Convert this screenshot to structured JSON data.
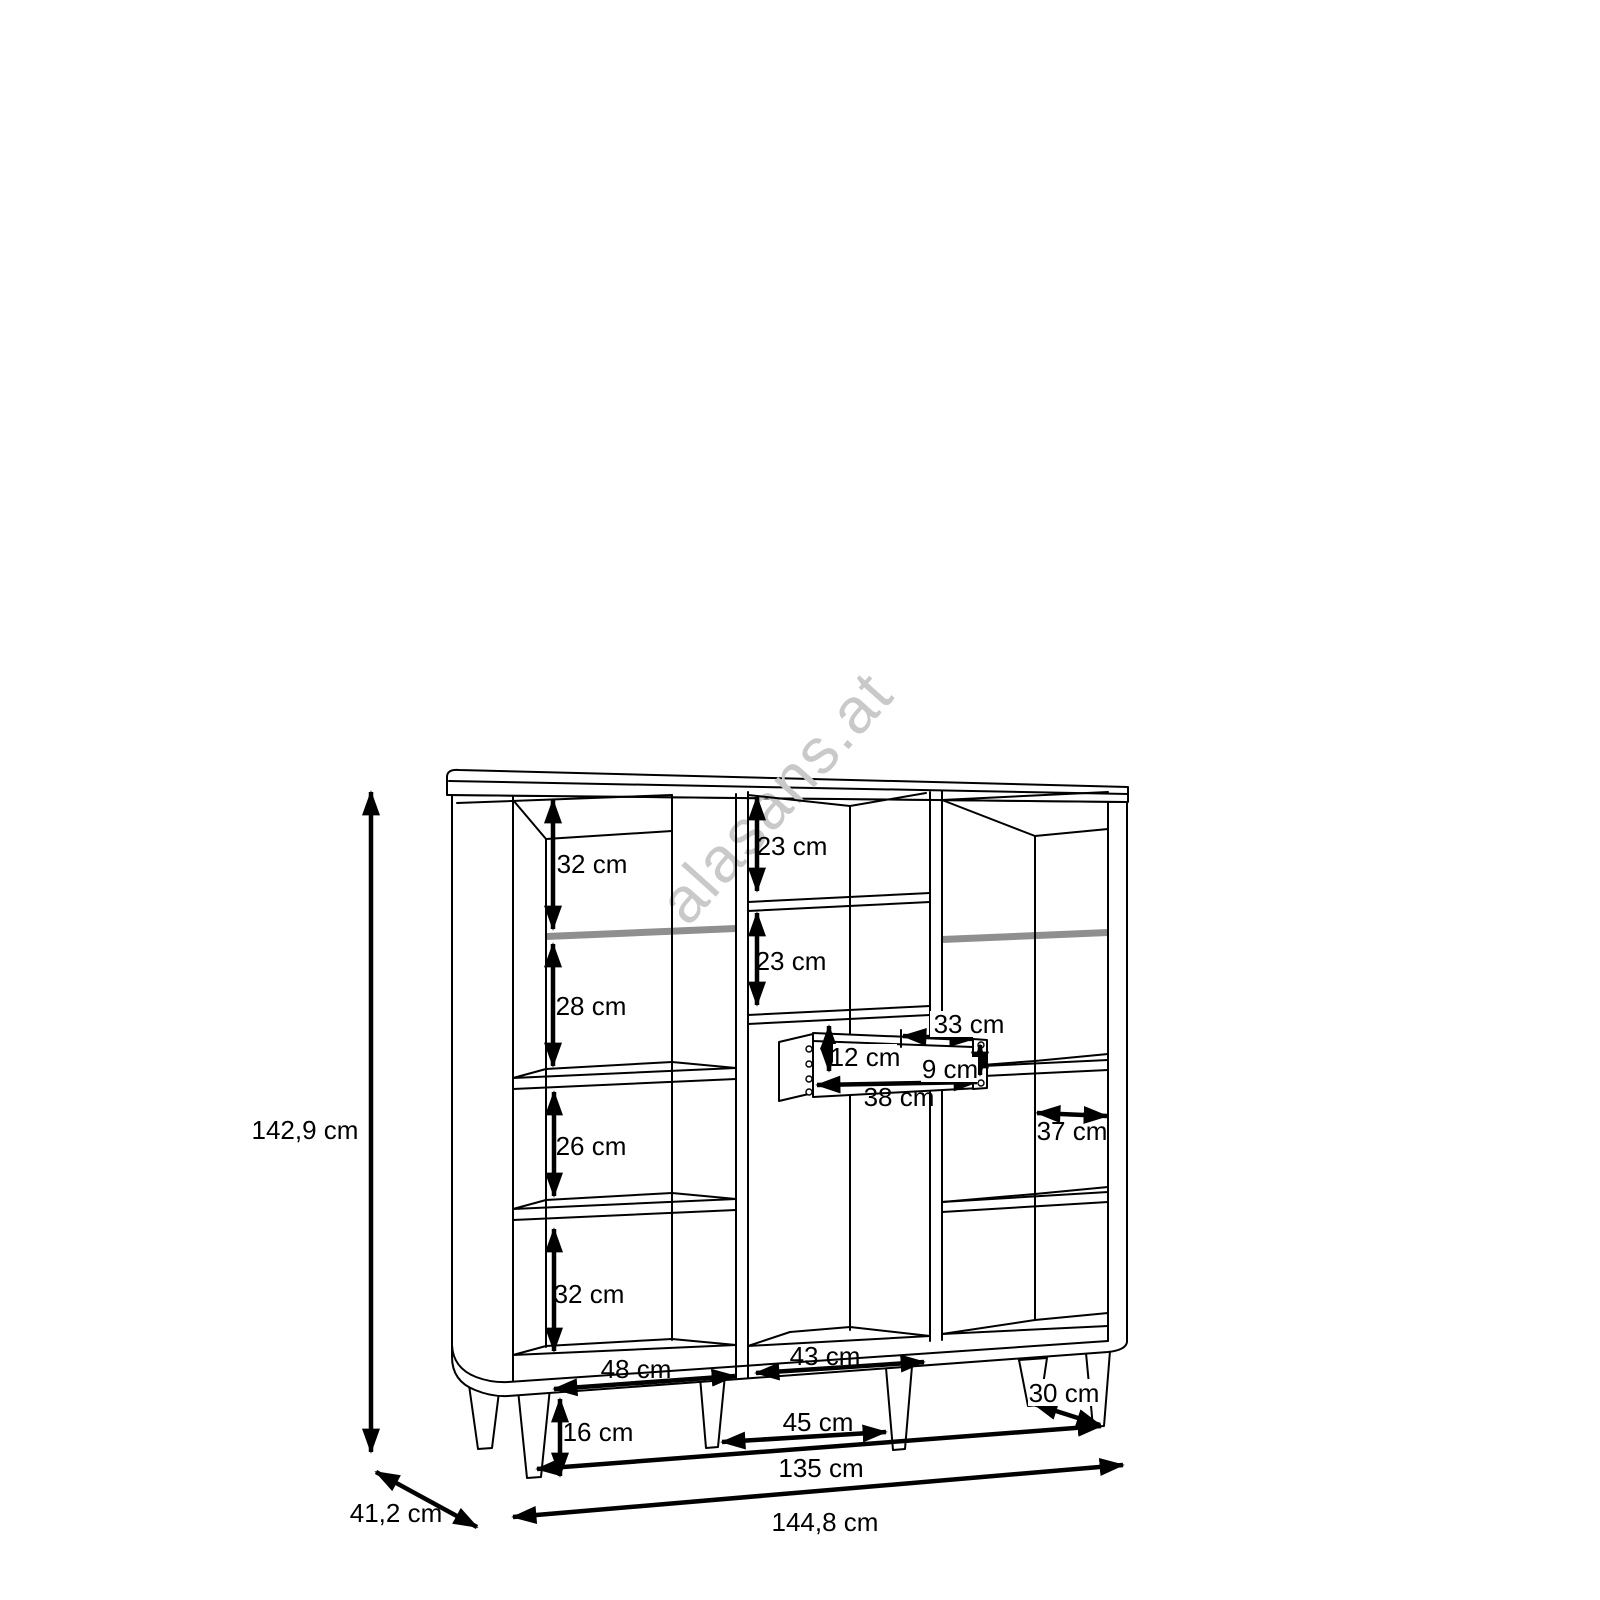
{
  "watermark": {
    "text": "alasans.at"
  },
  "diagram": {
    "kind": "cabinet-dimension-drawing",
    "unit": "cm",
    "labels": {
      "total_height": "142,9 cm",
      "total_width": "144,8 cm",
      "total_depth": "41,2 cm",
      "inner_width": "135 cm",
      "leg_height": "16 cm",
      "left_section_1": "32 cm",
      "left_section_2": "28 cm",
      "left_section_3": "26 cm",
      "left_section_4": "32 cm",
      "middle_section_1": "23 cm",
      "middle_section_2": "23 cm",
      "drawer_inner_height": "12 cm",
      "drawer_back_width": "33 cm",
      "drawer_side_height": "9 cm",
      "drawer_depth": "38 cm",
      "right_shelf_depth": "37 cm",
      "left_bay_width": "48 cm",
      "middle_bay_width": "43 cm",
      "middle_leg_span": "45 cm",
      "right_leg_span": "30 cm"
    }
  }
}
